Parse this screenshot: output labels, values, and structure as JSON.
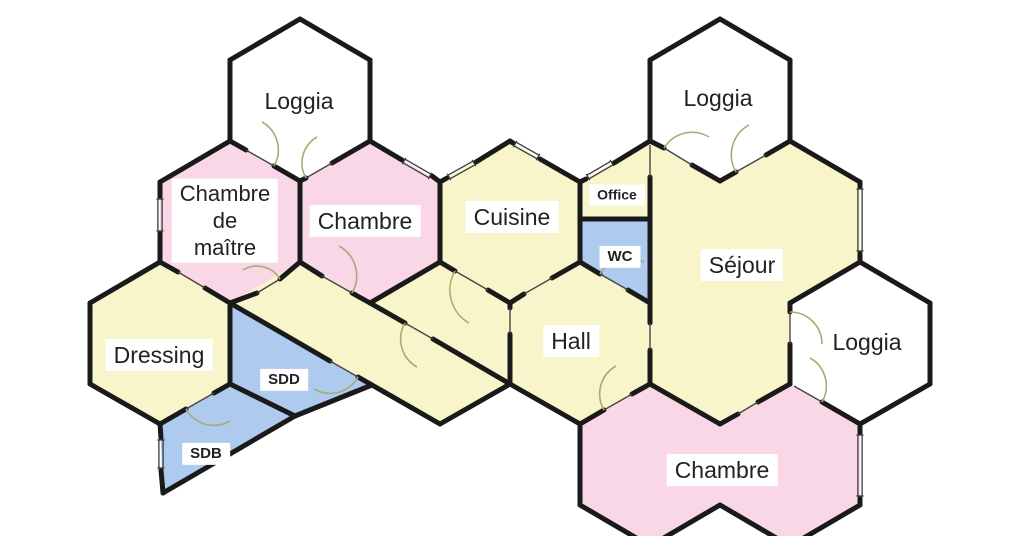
{
  "title": "Plan hexagonal d'appartement",
  "canvas": {
    "w": 1024,
    "h": 536
  },
  "colors": {
    "room_yellow": "#f8f5cb",
    "room_pink": "#fad7e6",
    "room_blue": "#aecaee",
    "room_white": "#ffffff",
    "wall": "#1a1a1a",
    "thin_line": "#454545",
    "window_line": "#3a3a3a",
    "door_arc": "#a9ab74",
    "label_text": "#222222",
    "label_bg": "#ffffff",
    "background": "#ffffff"
  },
  "rooms": [
    {
      "id": "loggia-top-left",
      "fill": "room_white",
      "points": "300,19 370,60 370,141 300,181 230,141 230,60"
    },
    {
      "id": "loggia-top-right",
      "fill": "room_white",
      "points": "720,19 790,60 790,141 720,181 650,141 650,60"
    },
    {
      "id": "loggia-right",
      "fill": "room_white",
      "points": "860,262 930,303 930,384 860,424 790,384 790,303"
    },
    {
      "id": "chambre-de-maitre",
      "fill": "room_pink",
      "points": "230,141 300,182 300,262 230,303 160,262 160,182"
    },
    {
      "id": "chambre-top",
      "fill": "room_pink",
      "points": "370,141 440,182 440,262 370,303 300,262 300,182"
    },
    {
      "id": "cuisine",
      "fill": "room_yellow",
      "points": "510,141 580,182 580,262 510,303 440,262 440,182"
    },
    {
      "id": "office",
      "fill": "room_yellow",
      "points": "580,182 650,141 650,219 580,219"
    },
    {
      "id": "wc",
      "fill": "room_blue",
      "points": "580,219 650,219 650,303 580,262"
    },
    {
      "id": "sejour",
      "fill": "room_yellow",
      "points": "650,141 720,182 790,141 860,182 860,262 790,303 790,384 720,424 650,384"
    },
    {
      "id": "hall",
      "fill": "room_yellow",
      "points": "230,303 300,262 370,303 440,262 510,303 580,262 650,303 650,384 580,424 510,384 440,424"
    },
    {
      "id": "dressing",
      "fill": "room_yellow",
      "points": "160,262 230,303 230,384 160,424 90,384 90,303"
    },
    {
      "id": "sdd",
      "fill": "room_blue",
      "points": "230,303 372,385 295,416 230,384"
    },
    {
      "id": "sdb",
      "fill": "room_blue",
      "points": "230,384 295,416 163,493 160,424"
    },
    {
      "id": "chambre-bottom",
      "fill": "room_pink",
      "points": "650,384 720,424 790,384 860,424 860,505 790,546 720,505 650,546 580,505 580,424"
    }
  ],
  "walls_thick": [
    [
      230,
      60,
      300,
      19
    ],
    [
      300,
      19,
      370,
      60
    ],
    [
      370,
      60,
      370,
      141
    ],
    [
      230,
      60,
      230,
      141
    ],
    [
      230,
      141,
      246,
      150
    ],
    [
      274,
      166,
      300,
      181
    ],
    [
      300,
      181,
      306,
      178
    ],
    [
      332,
      163,
      370,
      141
    ],
    [
      650,
      60,
      720,
      19
    ],
    [
      720,
      19,
      790,
      60
    ],
    [
      790,
      60,
      790,
      141
    ],
    [
      650,
      60,
      650,
      141
    ],
    [
      650,
      141,
      664,
      148
    ],
    [
      692,
      165,
      720,
      181
    ],
    [
      720,
      181,
      736,
      172
    ],
    [
      766,
      155,
      790,
      141
    ],
    [
      160,
      182,
      160,
      197
    ],
    [
      160,
      233,
      160,
      262
    ],
    [
      160,
      182,
      230,
      141
    ],
    [
      300,
      182,
      300,
      262
    ],
    [
      230,
      303,
      257,
      293
    ],
    [
      280,
      279,
      300,
      262
    ],
    [
      160,
      262,
      178,
      272
    ],
    [
      205,
      288,
      230,
      303
    ],
    [
      370,
      141,
      402,
      160
    ],
    [
      432,
      176,
      440,
      182
    ],
    [
      440,
      182,
      440,
      262
    ],
    [
      440,
      262,
      370,
      303
    ],
    [
      370,
      303,
      352,
      293
    ],
    [
      322,
      276,
      300,
      262
    ],
    [
      440,
      182,
      447,
      178
    ],
    [
      476,
      162,
      510,
      141
    ],
    [
      510,
      141,
      513,
      143
    ],
    [
      540,
      159,
      580,
      182
    ],
    [
      580,
      182,
      580,
      262
    ],
    [
      580,
      262,
      552,
      278
    ],
    [
      524,
      294,
      510,
      303
    ],
    [
      440,
      262,
      455,
      271
    ],
    [
      488,
      290,
      510,
      303
    ],
    [
      580,
      182,
      586,
      179
    ],
    [
      614,
      163,
      650,
      141
    ],
    [
      650,
      177,
      650,
      303
    ],
    [
      580,
      219,
      650,
      219
    ],
    [
      580,
      262,
      600,
      274
    ],
    [
      628,
      290,
      650,
      303
    ],
    [
      790,
      141,
      860,
      182
    ],
    [
      860,
      182,
      860,
      187
    ],
    [
      860,
      253,
      860,
      262
    ],
    [
      860,
      262,
      790,
      303
    ],
    [
      790,
      303,
      790,
      312
    ],
    [
      790,
      344,
      790,
      384
    ],
    [
      790,
      384,
      758,
      402
    ],
    [
      738,
      414,
      720,
      424
    ],
    [
      720,
      424,
      650,
      384
    ],
    [
      650,
      303,
      650,
      323
    ],
    [
      650,
      350,
      650,
      384
    ],
    [
      650,
      384,
      632,
      394
    ],
    [
      604,
      410,
      580,
      424
    ],
    [
      580,
      424,
      510,
      384
    ],
    [
      510,
      384,
      440,
      424
    ],
    [
      510,
      303,
      510,
      308
    ],
    [
      510,
      334,
      510,
      384
    ],
    [
      370,
      303,
      405,
      323
    ],
    [
      433,
      339,
      510,
      384
    ],
    [
      230,
      303,
      330,
      361
    ],
    [
      358,
      377,
      440,
      424
    ],
    [
      230,
      303,
      230,
      384
    ],
    [
      230,
      384,
      214,
      393
    ],
    [
      186,
      409,
      160,
      424
    ],
    [
      160,
      424,
      90,
      384
    ],
    [
      90,
      384,
      90,
      303
    ],
    [
      90,
      303,
      160,
      262
    ],
    [
      372,
      385,
      295,
      416
    ],
    [
      295,
      416,
      230,
      384
    ],
    [
      295,
      416,
      163,
      493
    ],
    [
      163,
      493,
      161,
      470
    ],
    [
      161,
      438,
      160,
      424
    ],
    [
      822,
      402,
      860,
      424
    ],
    [
      860,
      424,
      860,
      433
    ],
    [
      860,
      498,
      860,
      505
    ],
    [
      860,
      505,
      790,
      546
    ],
    [
      790,
      546,
      720,
      505
    ],
    [
      720,
      505,
      650,
      546
    ],
    [
      650,
      546,
      580,
      505
    ],
    [
      580,
      505,
      580,
      424
    ],
    [
      860,
      262,
      930,
      303
    ],
    [
      930,
      303,
      930,
      384
    ],
    [
      930,
      384,
      860,
      424
    ]
  ],
  "walls_thin": [
    [
      246,
      150,
      274,
      166
    ],
    [
      306,
      178,
      332,
      163
    ],
    [
      664,
      148,
      692,
      165
    ],
    [
      736,
      172,
      766,
      155
    ],
    [
      257,
      293,
      280,
      279
    ],
    [
      178,
      272,
      205,
      288
    ],
    [
      352,
      293,
      322,
      276
    ],
    [
      552,
      278,
      524,
      294
    ],
    [
      455,
      271,
      488,
      290
    ],
    [
      600,
      274,
      628,
      290
    ],
    [
      650,
      145,
      650,
      177
    ],
    [
      790,
      312,
      790,
      344
    ],
    [
      650,
      323,
      650,
      350
    ],
    [
      758,
      402,
      738,
      414
    ],
    [
      632,
      394,
      604,
      410
    ],
    [
      510,
      308,
      510,
      334
    ],
    [
      405,
      323,
      433,
      339
    ],
    [
      330,
      361,
      358,
      377
    ],
    [
      214,
      393,
      186,
      409
    ],
    [
      794,
      386,
      822,
      402
    ]
  ],
  "windows": [
    [
      160,
      199,
      160,
      231
    ],
    [
      404,
      161,
      430,
      176
    ],
    [
      449,
      177,
      474,
      163
    ],
    [
      515,
      144,
      538,
      157
    ],
    [
      588,
      177,
      612,
      163
    ],
    [
      860,
      189,
      860,
      251
    ],
    [
      860,
      435,
      860,
      496
    ],
    [
      161,
      440,
      161,
      468
    ]
  ],
  "door_arcs": [
    "M274,166 A32,32 0 0 0 262,122",
    "M306,178 A30,30 0 0 1 317,137",
    "M664,148 A33,33 0 0 1 709,137",
    "M736,172 A34,34 0 0 1 749,125",
    "M352,293 A34,34 0 0 0 339,246",
    "M280,279 A27,27 0 0 0 243,270",
    "M455,271 A38,38 0 0 0 469,323",
    "M405,323 A32,32 0 0 0 417,367",
    "M600,274 A32,32 0 0 1 644,262",
    "M604,410 A32,32 0 0 1 616,366",
    "M790,312 A32,32 0 0 1 822,344",
    "M822,402 A32,32 0 0 0 810,358",
    "M186,409 A32,32 0 0 0 230,421",
    "M358,377 A32,32 0 0 1 314,389"
  ],
  "labels": [
    {
      "id": "loggia-top-left",
      "text": "Loggia",
      "x": 299,
      "y": 101,
      "size": 23,
      "bold": false
    },
    {
      "id": "loggia-top-right",
      "text": "Loggia",
      "x": 718,
      "y": 98,
      "size": 23,
      "bold": false
    },
    {
      "id": "chambre-de-maitre",
      "text": "Chambre\nde\nmaître",
      "x": 225,
      "y": 221,
      "size": 22,
      "bold": false
    },
    {
      "id": "chambre-top",
      "text": "Chambre",
      "x": 365,
      "y": 221,
      "size": 23,
      "bold": false
    },
    {
      "id": "cuisine",
      "text": "Cuisine",
      "x": 512,
      "y": 217,
      "size": 23,
      "bold": false
    },
    {
      "id": "office",
      "text": "Office",
      "x": 617,
      "y": 195,
      "size": 14,
      "bold": true
    },
    {
      "id": "wc",
      "text": "WC",
      "x": 620,
      "y": 257,
      "size": 15,
      "bold": true
    },
    {
      "id": "sejour",
      "text": "Séjour",
      "x": 742,
      "y": 265,
      "size": 23,
      "bold": false
    },
    {
      "id": "hall",
      "text": "Hall",
      "x": 571,
      "y": 341,
      "size": 23,
      "bold": false
    },
    {
      "id": "loggia-right",
      "text": "Loggia",
      "x": 867,
      "y": 342,
      "size": 23,
      "bold": false
    },
    {
      "id": "dressing",
      "text": "Dressing",
      "x": 159,
      "y": 355,
      "size": 23,
      "bold": false
    },
    {
      "id": "sdd",
      "text": "SDD",
      "x": 284,
      "y": 380,
      "size": 15,
      "bold": true
    },
    {
      "id": "sdb",
      "text": "SDB",
      "x": 206,
      "y": 454,
      "size": 15,
      "bold": true
    },
    {
      "id": "chambre-bottom",
      "text": "Chambre",
      "x": 722,
      "y": 470,
      "size": 23,
      "bold": false
    }
  ]
}
